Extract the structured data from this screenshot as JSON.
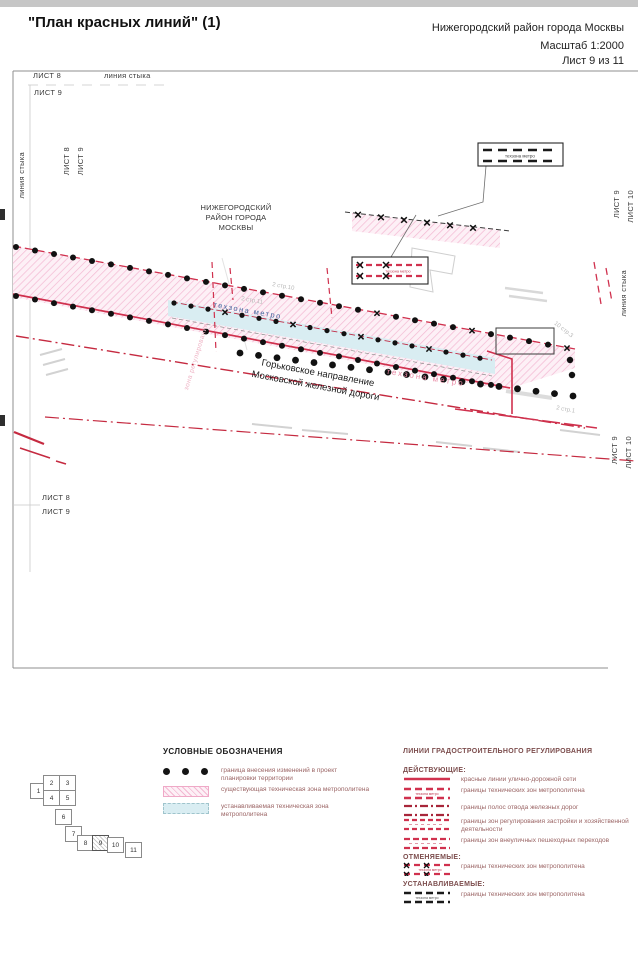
{
  "header": {
    "title": "\"План красных линий\" (1)",
    "district": "Нижегородский район города Москвы",
    "scale": "Масштаб 1:2000",
    "sheet": "Лист 9 из 11"
  },
  "map": {
    "district": "НИЖЕГОРОДСКИЙ\nРАЙОН ГОРОДА\nМОСКВЫ",
    "railway": "Горьковское направление\nМосковской железной дороги",
    "techzone_metro_blue": "техзона метро",
    "techzone_metro_pink": "техзона метро",
    "zone_regulation": "зона регулирования",
    "callout_installed": "техзона метро",
    "callout_cancelled": "техзона метро",
    "building_labels": [
      "2 стр.10",
      "2 стр.11",
      "10 стр.3",
      "2 стр.1"
    ],
    "edges": {
      "top_sheet8": "ЛИСТ 8",
      "top_seam": "линия стыка",
      "top_sheet9": "ЛИСТ 9",
      "left_seam": "линия стыка",
      "left_sheet8": "ЛИСТ 8",
      "left_sheet9": "ЛИСТ 9",
      "right_sheet9_top": "ЛИСТ 9",
      "right_sheet10_top": "ЛИСТ 10",
      "right_seam": "линия стыка",
      "right_sheet9_bottom": "ЛИСТ 9",
      "right_sheet10_bottom": "ЛИСТ 10",
      "bottom_sheet8": "ЛИСТ 8",
      "bottom_sheet9": "ЛИСТ 9"
    }
  },
  "sheet_index": {
    "sheets": [
      "1",
      "2",
      "3",
      "4",
      "5",
      "6",
      "7",
      "8",
      "9",
      "10",
      "11"
    ],
    "current": "9"
  },
  "legend_symbols": {
    "title": "УСЛОВНЫЕ ОБОЗНАЧЕНИЯ",
    "items": [
      {
        "label": "граница внесения изменений в проект планировки территории"
      },
      {
        "label": "существующая техническая зона метрополитена"
      },
      {
        "label": "устанавливаемая техническая зона метрополитена"
      }
    ]
  },
  "legend_lines": {
    "title": "ЛИНИИ ГРАДОСТРОИТЕЛЬНОГО РЕГУЛИРОВАНИЯ",
    "sections": [
      {
        "heading": "ДЕЙСТВУЮЩИЕ:",
        "items": [
          {
            "label": "красные линии улично-дорожной сети",
            "micro": ""
          },
          {
            "label": "границы технических зон метрополитена",
            "micro": "техзона метро"
          },
          {
            "label": "границы полос отвода железных дорог",
            "micro": ""
          },
          {
            "label": "границы зон регулирования застройки и хозяйственной деятельности",
            "micro": ""
          },
          {
            "label": "границы зон внеуличных пешеходных переходов",
            "micro": ""
          }
        ]
      },
      {
        "heading": "ОТМЕНЯЕМЫЕ:",
        "items": [
          {
            "label": "границы технических зон метрополитена",
            "micro": "техзона метро"
          }
        ]
      },
      {
        "heading": "УСТАНАВЛИВАЕМЫЕ:",
        "items": [
          {
            "label": "границы технических зон метрополитена",
            "micro": "техзона метро"
          }
        ]
      }
    ]
  },
  "colors": {
    "red_line": "#d0314e",
    "railway_red": "#c52a40",
    "pink_zone_bg": "#fdf0f6",
    "pink_zone_hatch": "#f3b8d2",
    "cyan_zone": "#d9edf2",
    "legend_text": "#9b6565"
  }
}
